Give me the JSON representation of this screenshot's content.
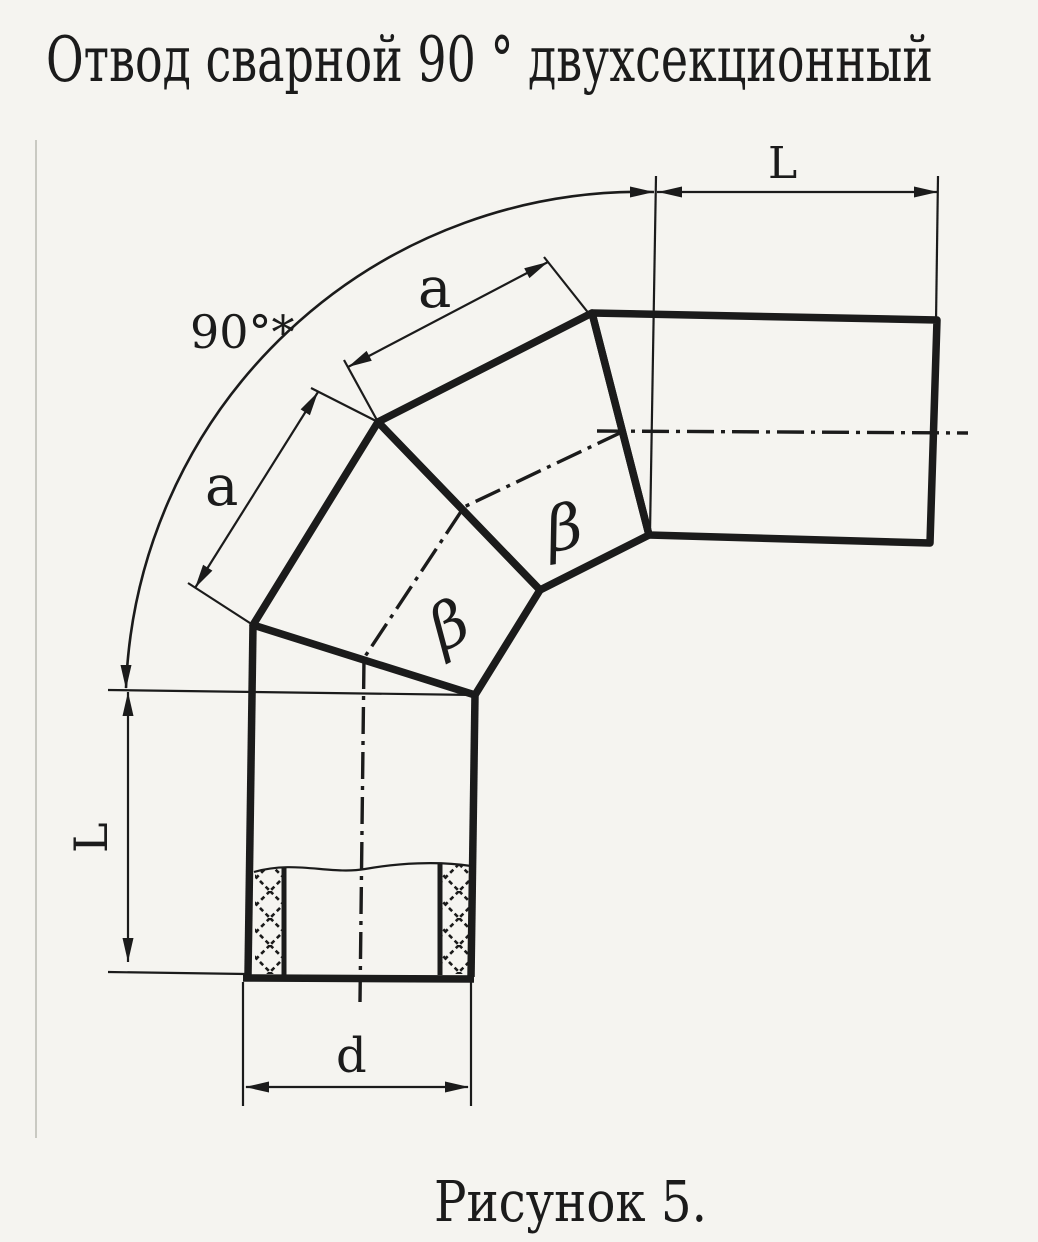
{
  "page": {
    "title": "Отвод сварной 90 ° двухсекционный",
    "caption": "Рисунок 5."
  },
  "dimensions": {
    "angle": "90°*",
    "outlet_length": "L",
    "inlet_length": "L",
    "segment_upper": "a",
    "segment_lower": "a",
    "diameter": "d"
  },
  "annotations": {
    "bevel_angle_upper": "β",
    "bevel_angle_lower": "β"
  },
  "colors": {
    "ink": "#1b1b1b",
    "paper": "#f5f4f0"
  }
}
